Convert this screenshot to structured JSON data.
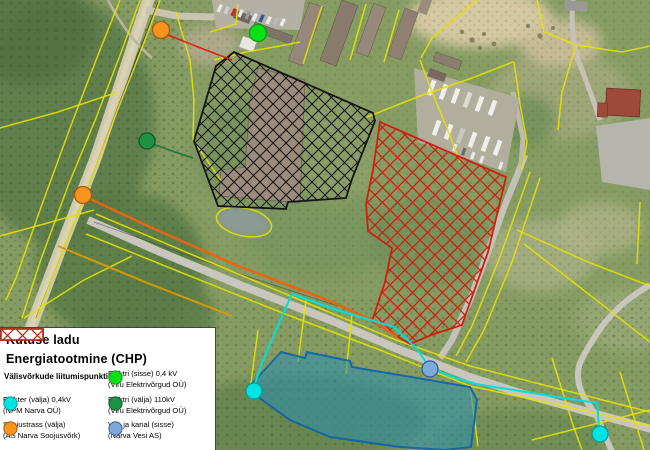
{
  "legend": {
    "areas": [
      {
        "label": "Kütuse ladu",
        "color": "#151515"
      },
      {
        "label": "Energiatootmine (CHP)",
        "color": "#cf1f10"
      }
    ],
    "section_title": "Välisvõrkude liitumispunktid:",
    "points": [
      {
        "label": "Elektri (sisse) 0,4 kV",
        "org": "(Viru Elektrivõrgud OÜ)",
        "color": "#0ae016"
      },
      {
        "label": "Elekter (välja) 0,4kV",
        "org": "(NPM Narva OÜ)",
        "color": "#00e3e3"
      },
      {
        "label": "Elektri (välja) 110kV",
        "org": "(Viru Elektrivõrgud OÜ)",
        "color": "#1f9143"
      },
      {
        "label": "Soojustrass (välja)",
        "org": "(AS Narva Soojusvõrk)",
        "color": "#f7941e"
      },
      {
        "label": "Vee ja kanal (sisse)",
        "org": "(Narva Vesi AS)",
        "color": "#7fa9d6"
      }
    ]
  },
  "map": {
    "routes": {
      "cyan": "#00dede",
      "orange": "#e8650f",
      "red": "#de2310",
      "green": "#1c7a38"
    },
    "cadastral_line_color": "#e6e200",
    "markers": [
      {
        "id": "marker-heating-north",
        "type": "Soojustrass (välja)"
      },
      {
        "id": "marker-electric-in-north",
        "type": "Elektri (sisse) 0,4 kV"
      },
      {
        "id": "marker-electric-110kv-west",
        "type": "Elektri (välja) 110kV"
      },
      {
        "id": "marker-heating-west",
        "type": "Soojustrass (välja)"
      },
      {
        "id": "marker-electric-out-south",
        "type": "Elekter (välja) 0,4kV"
      },
      {
        "id": "marker-water-south",
        "type": "Vee ja kanal (sisse)"
      },
      {
        "id": "marker-electric-out-southeast",
        "type": "Elekter (välja) 0,4kV"
      }
    ]
  }
}
